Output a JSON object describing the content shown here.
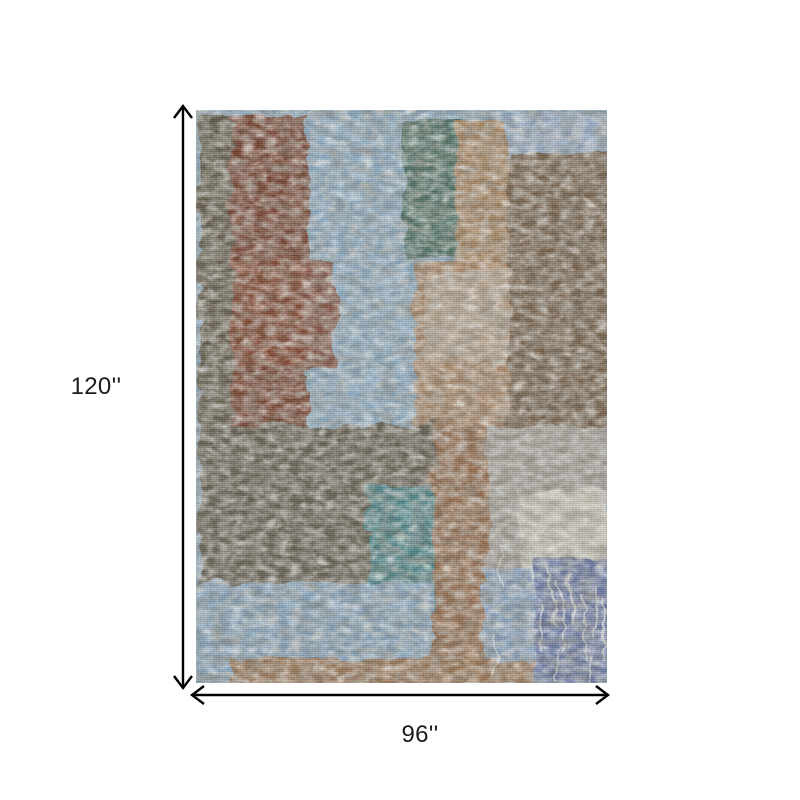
{
  "page": {
    "background_color": "#ffffff"
  },
  "dimensions": {
    "height_label": "120''",
    "width_label": "96''",
    "arrow_color": "#000000",
    "label_color": "#1c1c1c"
  },
  "rug": {
    "description_colors": {
      "steel_blue": "#8CA9BF",
      "rust": "#7C4530",
      "brown": "#7C6650",
      "olive_gray": "#67614F",
      "teal": "#4F898E",
      "warm_gray": "#ACA8A1",
      "periwinkle": "#7282AE",
      "tan": "#B58A62",
      "cream": "#D7D3C5"
    },
    "base_color": "#8CA9BF",
    "drip_color": "#EDEDE7",
    "patches": [
      {
        "x": 0,
        "y": 0,
        "w": 40,
        "h": 318,
        "c": "#67614F"
      },
      {
        "x": 0,
        "y": 0,
        "w": 120,
        "h": 20,
        "c": "#5E5A4C",
        "o": 0.7
      },
      {
        "x": 33,
        "y": 0,
        "w": 80,
        "h": 320,
        "c": "#7C4530"
      },
      {
        "x": 108,
        "y": 0,
        "w": 200,
        "h": 322,
        "c": "#92B2CA"
      },
      {
        "x": 205,
        "y": 6,
        "w": 58,
        "h": 138,
        "c": "#507569"
      },
      {
        "x": 256,
        "y": 8,
        "w": 54,
        "h": 155,
        "c": "#B4885E",
        "o": 0.9
      },
      {
        "x": 306,
        "y": 0,
        "w": 105,
        "h": 44,
        "c": "#9DB2CC"
      },
      {
        "x": 308,
        "y": 38,
        "w": 103,
        "h": 280,
        "c": "#7C6650"
      },
      {
        "x": 214,
        "y": 150,
        "w": 96,
        "h": 172,
        "c": "#B58A62",
        "o": 0.88
      },
      {
        "x": 34,
        "y": 148,
        "w": 104,
        "h": 106,
        "c": "#8A4A33",
        "o": 0.85
      },
      {
        "x": 224,
        "y": 160,
        "w": 86,
        "h": 88,
        "c": "#CBC6BA",
        "o": 0.5
      },
      {
        "x": 0,
        "y": 312,
        "w": 234,
        "h": 162,
        "c": "#6B6455"
      },
      {
        "x": 234,
        "y": 312,
        "w": 56,
        "h": 258,
        "c": "#9C7253"
      },
      {
        "x": 289,
        "y": 312,
        "w": 122,
        "h": 148,
        "c": "#ACA8A1"
      },
      {
        "x": 320,
        "y": 378,
        "w": 91,
        "h": 82,
        "c": "#D7D3C5",
        "o": 0.85
      },
      {
        "x": 169,
        "y": 374,
        "w": 66,
        "h": 128,
        "c": "#4F898E"
      },
      {
        "x": 0,
        "y": 470,
        "w": 234,
        "h": 92,
        "c": "#8EACC5"
      },
      {
        "x": 284,
        "y": 452,
        "w": 50,
        "h": 121,
        "c": "#8FA9C6"
      },
      {
        "x": 334,
        "y": 444,
        "w": 77,
        "h": 129,
        "c": "#7282AE"
      },
      {
        "x": 34,
        "y": 546,
        "w": 300,
        "h": 27,
        "c": "#A17A57",
        "o": 0.95
      }
    ],
    "drips": [
      {
        "x": 352,
        "y": 455,
        "w": 3,
        "h": 60
      },
      {
        "x": 362,
        "y": 470,
        "w": 2,
        "h": 75
      },
      {
        "x": 372,
        "y": 462,
        "w": 3,
        "h": 48
      },
      {
        "x": 383,
        "y": 480,
        "w": 2,
        "h": 70
      },
      {
        "x": 394,
        "y": 470,
        "w": 2,
        "h": 55
      },
      {
        "x": 402,
        "y": 485,
        "w": 2,
        "h": 60
      },
      {
        "x": 340,
        "y": 490,
        "w": 2,
        "h": 50
      },
      {
        "x": 300,
        "y": 430,
        "w": 2,
        "h": 40
      },
      {
        "x": 330,
        "y": 435,
        "w": 3,
        "h": 30
      },
      {
        "x": 357,
        "y": 540,
        "w": 2,
        "h": 30
      },
      {
        "x": 388,
        "y": 545,
        "w": 2,
        "h": 26
      },
      {
        "x": 296,
        "y": 520,
        "w": 2,
        "h": 44
      }
    ]
  }
}
